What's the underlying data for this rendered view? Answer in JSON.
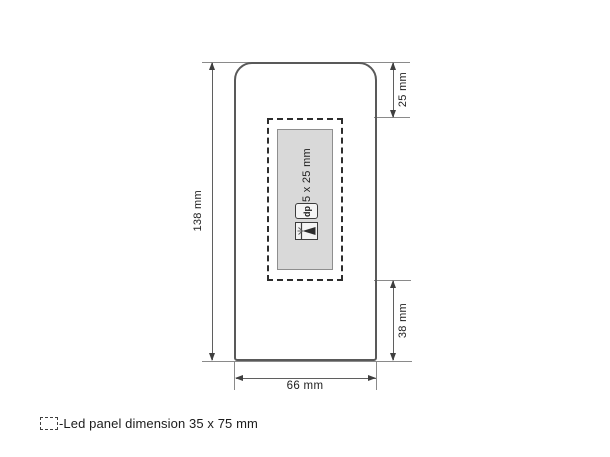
{
  "diagram": {
    "dimensions": {
      "height": "138 mm",
      "width": "66 mm",
      "panel_top_offset": "25 mm",
      "panel_bottom_offset": "38 mm"
    },
    "print_area": {
      "size_label": "65 x 25 mm",
      "icons": {
        "dp": "dp",
        "laser": "laser-engraving"
      }
    },
    "legend": {
      "label": "-Led panel dimension 35 x 75 mm"
    },
    "colors": {
      "background": "#ffffff",
      "panel_fill": "#d9d9d9",
      "panel_border": "#8e8e8e",
      "device_outline": "#595959",
      "dashed_outline": "#2d2d2d",
      "dimension_line": "#5f5f5f",
      "extension_line": "#8a8a8a",
      "text": "#1e1e1e"
    }
  }
}
